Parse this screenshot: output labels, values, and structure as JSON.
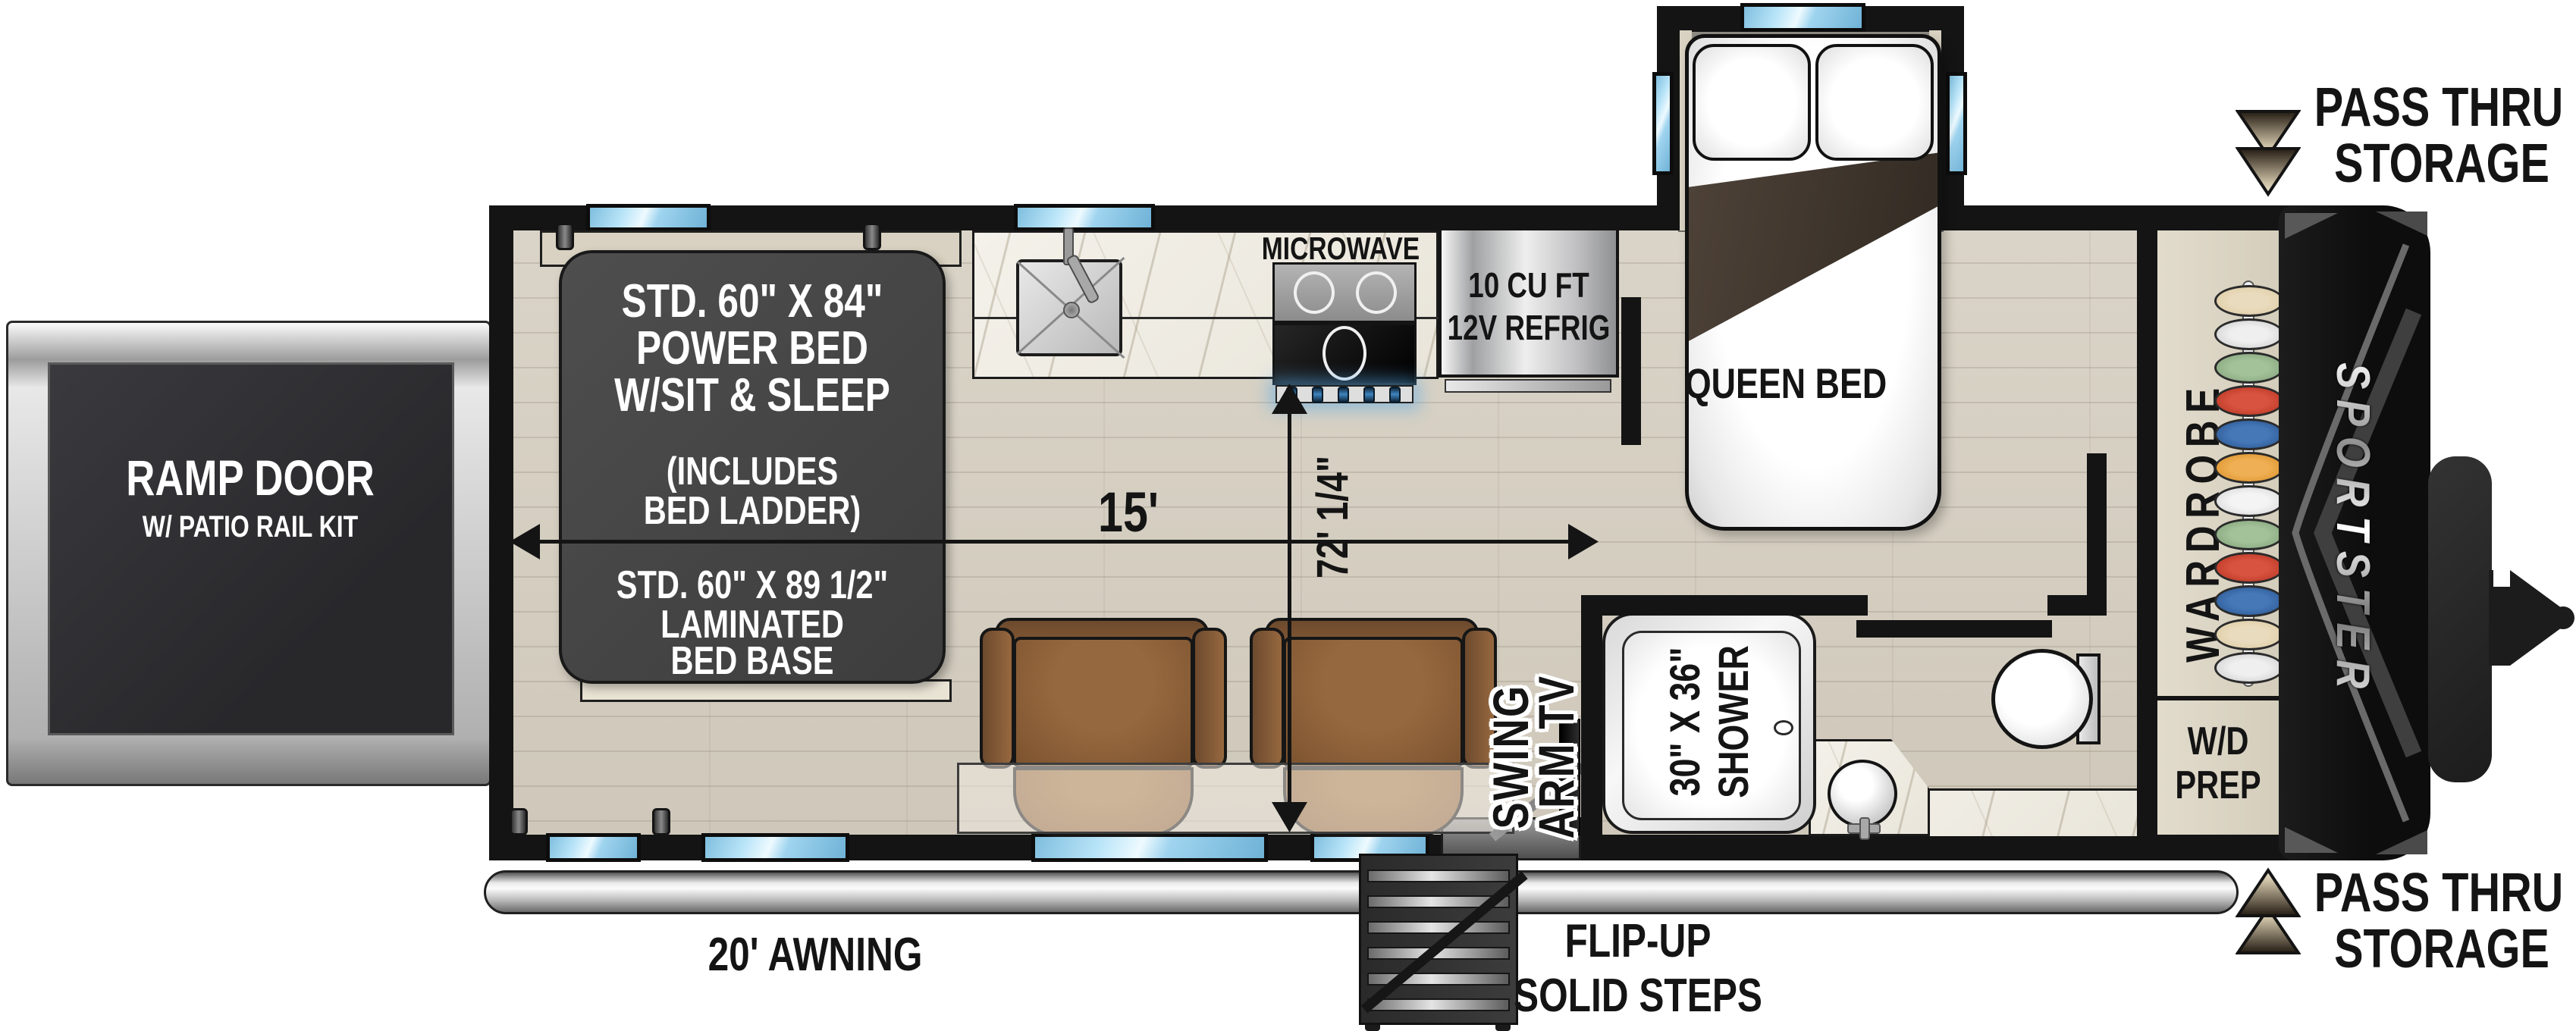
{
  "ramp_door": {
    "title": "RAMP DOOR",
    "subtitle": "W/ PATIO RAIL KIT"
  },
  "power_bed": {
    "l1": "STD. 60\" X 84\"",
    "l2": "POWER BED",
    "l3": "W/SIT & SLEEP",
    "l4": "(INCLUDES",
    "l5": "BED LADDER)"
  },
  "bed_base": {
    "l1": "STD. 60\" X 89 1/2\"",
    "l2": "LAMINATED",
    "l3": "BED BASE"
  },
  "kitchen": {
    "microwave": "MICROWAVE",
    "refrig_l1": "10 CU FT",
    "refrig_l2": "12V REFRIG"
  },
  "bedroom": {
    "queen_bed": "QUEEN BED",
    "wardrobe": "WARDROBE"
  },
  "bath": {
    "shower_l1": "30\" X 36\"",
    "shower_l2": "SHOWER",
    "wd_l1": "W/D",
    "wd_l2": "PREP"
  },
  "living": {
    "tv_l1": "SWING",
    "tv_l2": "ARM TV"
  },
  "dims": {
    "length": "15'",
    "width": "72' 1/4\""
  },
  "exterior": {
    "awning": "20' AWNING",
    "steps_l1": "FLIP-UP",
    "steps_l2": "SOLID STEPS",
    "pass_top_l1": "PASS THRU",
    "pass_top_l2": "STORAGE",
    "pass_bottom_l1": "PASS THRU",
    "pass_bottom_l2": "STORAGE",
    "brand": "SPORTSTER"
  },
  "colors": {
    "wall": "#141414",
    "floor_wood": "#d5cfc2",
    "window_blue": "#9fd4ef",
    "chair_brown": "#8a5c36",
    "blanket_brown": "#453a2f",
    "bed_panel_gray": "#474747",
    "refrig_silver": "#c9c9cb",
    "arrow_gradient_dark": "#241b12",
    "arrow_gradient_light": "#efe5d0",
    "hangers": [
      "#dcc9a0",
      "#d6d6d6",
      "#8fb087",
      "#c43a28",
      "#2e5f9f",
      "#e29a32",
      "#ececec",
      "#8fb087",
      "#c43a28",
      "#2e5f9f",
      "#dcc9a0",
      "#d6d6d6"
    ]
  }
}
